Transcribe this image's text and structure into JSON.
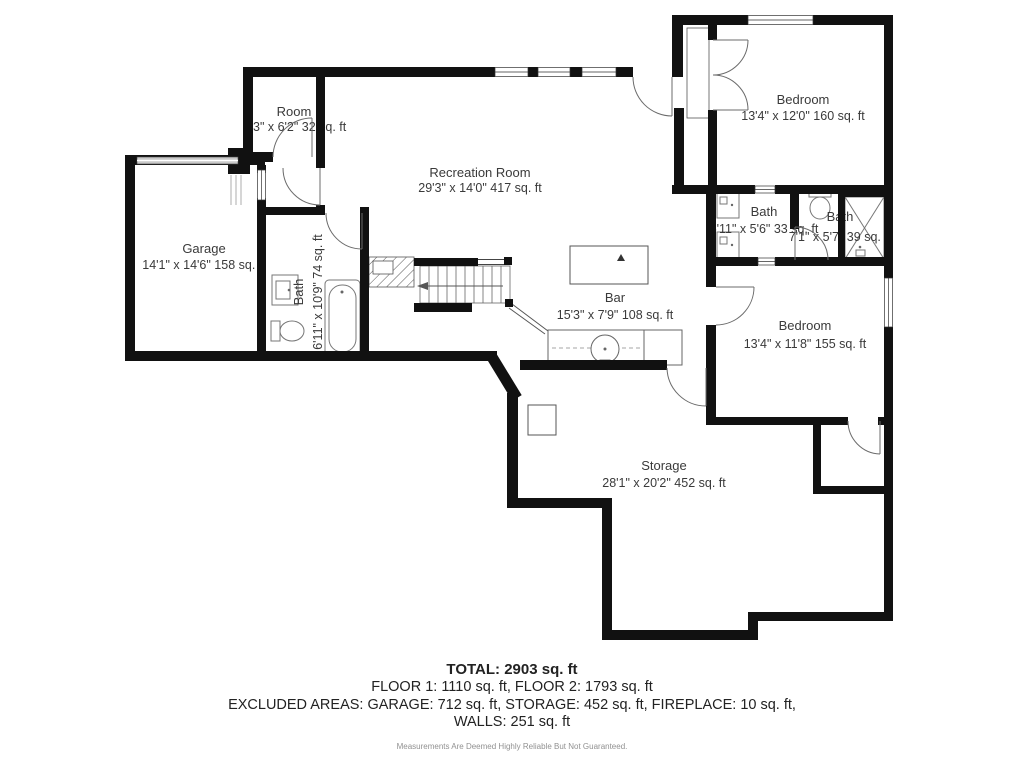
{
  "plan": {
    "rooms": {
      "room": {
        "name": "Room",
        "dims": "3\" x 6'2\" 32 sq. ft"
      },
      "recreation": {
        "name": "Recreation Room",
        "dims": "29'3\" x 14'0\" 417 sq. ft"
      },
      "bedroom1": {
        "name": "Bedroom",
        "dims": "13'4\" x 12'0\" 160 sq. ft"
      },
      "garage": {
        "name": "Garage",
        "dims": "14'1\" x 14'6\" 158 sq. ft"
      },
      "bath1": {
        "name": "Bath",
        "dims": "6'11\" x 10'9\" 74 sq. ft"
      },
      "bath2": {
        "name": "Bath",
        "dims": "5'11\" x 5'6\" 33 sq. ft"
      },
      "bath3": {
        "name": "Bath",
        "dims": "7'1\" x 5'7\" 39 sq. ft"
      },
      "bar": {
        "name": "Bar",
        "dims": "15'3\" x 7'9\" 108 sq. ft"
      },
      "bedroom2": {
        "name": "Bedroom",
        "dims": "13'4\" x 11'8\" 155 sq. ft"
      },
      "storage": {
        "name": "Storage",
        "dims": "28'1\" x 20'2\" 452 sq. ft"
      }
    },
    "summary": {
      "total": "TOTAL: 2903 sq. ft",
      "floors": "FLOOR 1: 1110 sq. ft, FLOOR 2: 1793 sq. ft",
      "excluded": "EXCLUDED AREAS: GARAGE: 712 sq. ft, STORAGE: 452 sq. ft, FIREPLACE: 10 sq. ft,",
      "walls": "WALLS: 251 sq. ft",
      "disclaimer": "Measurements Are Deemed Highly Reliable But Not Guaranteed."
    },
    "colors": {
      "wall": "#111111",
      "label_text": "#3a3a3a",
      "disclaimer_text": "#919191"
    }
  }
}
